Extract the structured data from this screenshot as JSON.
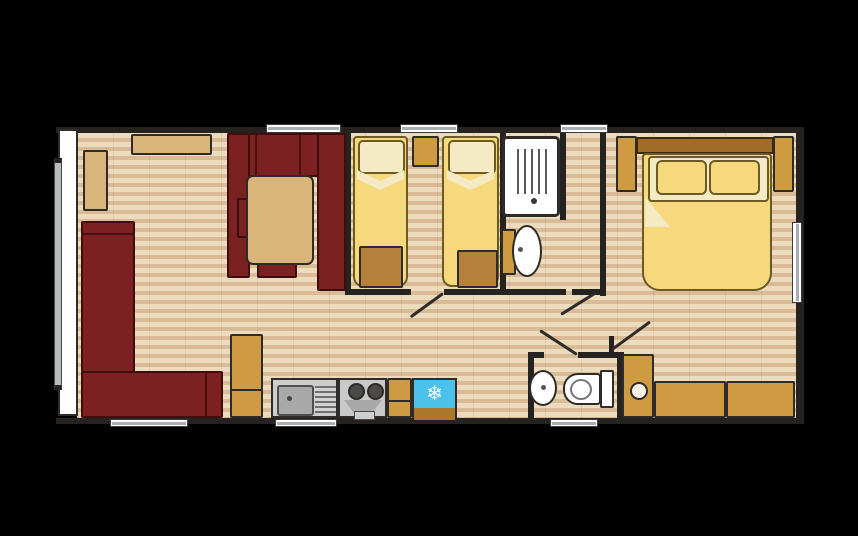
{
  "diagram": {
    "type": "floor-plan",
    "subject": "Two-bedroom static caravan / holiday home layout, open-plan lounge-kitchen",
    "background_color": "#000000"
  },
  "palette": {
    "wall": "#262220",
    "floor_light": "#ecdbbd",
    "floor_stripe": "#d9bc97",
    "upholstery_maroon": "#7b2121",
    "wood_tan": "#d9b57b",
    "cabinet_tan": "#cf9b42",
    "locker_brown": "#b5813d",
    "bedding_yellow": "#f5d97c",
    "linen_cream": "#f4ebc4",
    "headboard_brown": "#a06c28",
    "fridge_blue": "#4cc1e9",
    "appliance_grey": "#cdcdcd",
    "fixture_white": "#ffffff",
    "window_glass_grey": "#a9aeb3"
  },
  "glyphs": {
    "snowflake": "❄"
  },
  "rooms": {
    "lounge": {
      "name": "Lounge / dining area",
      "furniture": [
        "L-shaped corner sofa",
        "U-shaped dining booth",
        "dining table",
        "sideboard",
        "corner shelf",
        "storage cabinet"
      ]
    },
    "kitchen": {
      "name": "Kitchen",
      "appliances": [
        "sink with drainer",
        "two-burner hob with oven",
        "worktop unit",
        "fridge"
      ]
    },
    "twin_bedroom": {
      "name": "Twin bedroom",
      "furniture": [
        "single bed",
        "single bed",
        "bedside shelf",
        "foot-of-bed locker",
        "foot-of-bed locker"
      ]
    },
    "shower_room": {
      "name": "Shower room",
      "fixtures": [
        "shower cubicle",
        "wash basin with vanity"
      ]
    },
    "wc": {
      "name": "WC",
      "fixtures": [
        "wash basin",
        "toilet with cistern"
      ]
    },
    "master_bedroom": {
      "name": "Double bedroom",
      "furniture": [
        "double bed",
        "headboard",
        "bedside cabinet",
        "bedside cabinet",
        "chest of drawers",
        "chest of drawers",
        "wardrobe"
      ]
    }
  },
  "openings": {
    "windows": 8,
    "doors": 4
  }
}
